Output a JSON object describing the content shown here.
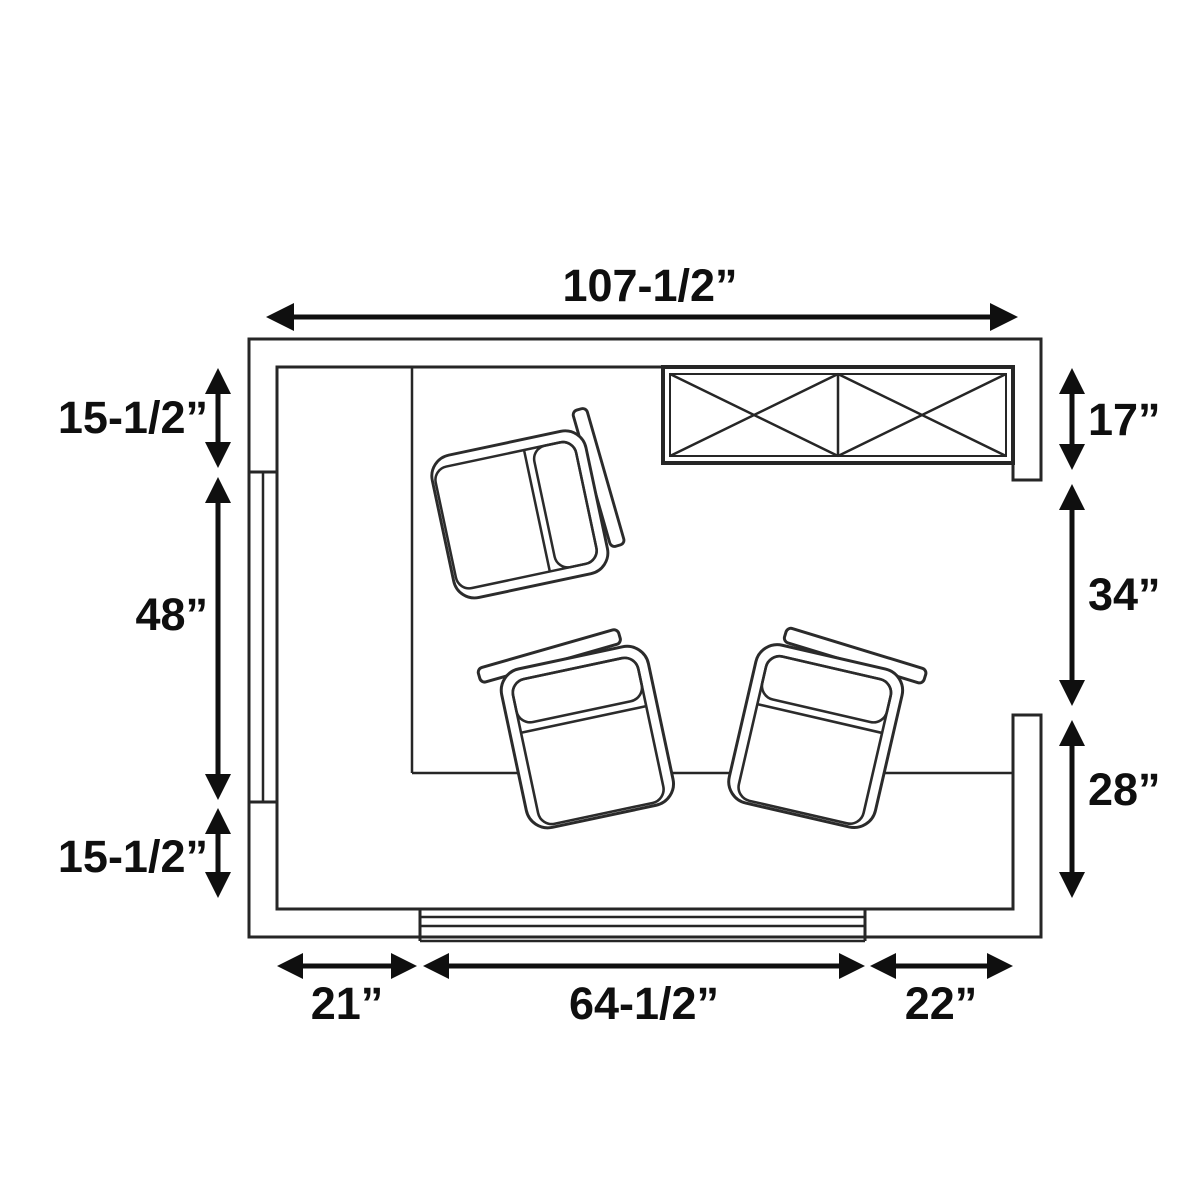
{
  "diagram": {
    "type": "floor-plan",
    "units": "inches",
    "background_color": "#ffffff",
    "line_color": "#262626",
    "dimension_color": "#0f0f0f",
    "features": {
      "cabinet": "double-crossed cabinet / console against top-right wall",
      "windows": [
        "left wall window",
        "bottom wall window"
      ],
      "opening": "right side wall opening between upper and lower wall sections",
      "chairs": 3
    },
    "dims": {
      "top_width": "107-1/2”",
      "left_top": "15-1/2”",
      "left_middle": "48”",
      "left_bottom": "15-1/2”",
      "right_top": "17”",
      "right_middle": "34”",
      "right_bottom": "28”",
      "bottom_left": "21”",
      "bottom_middle": "64-1/2”",
      "bottom_right": "22”"
    }
  }
}
